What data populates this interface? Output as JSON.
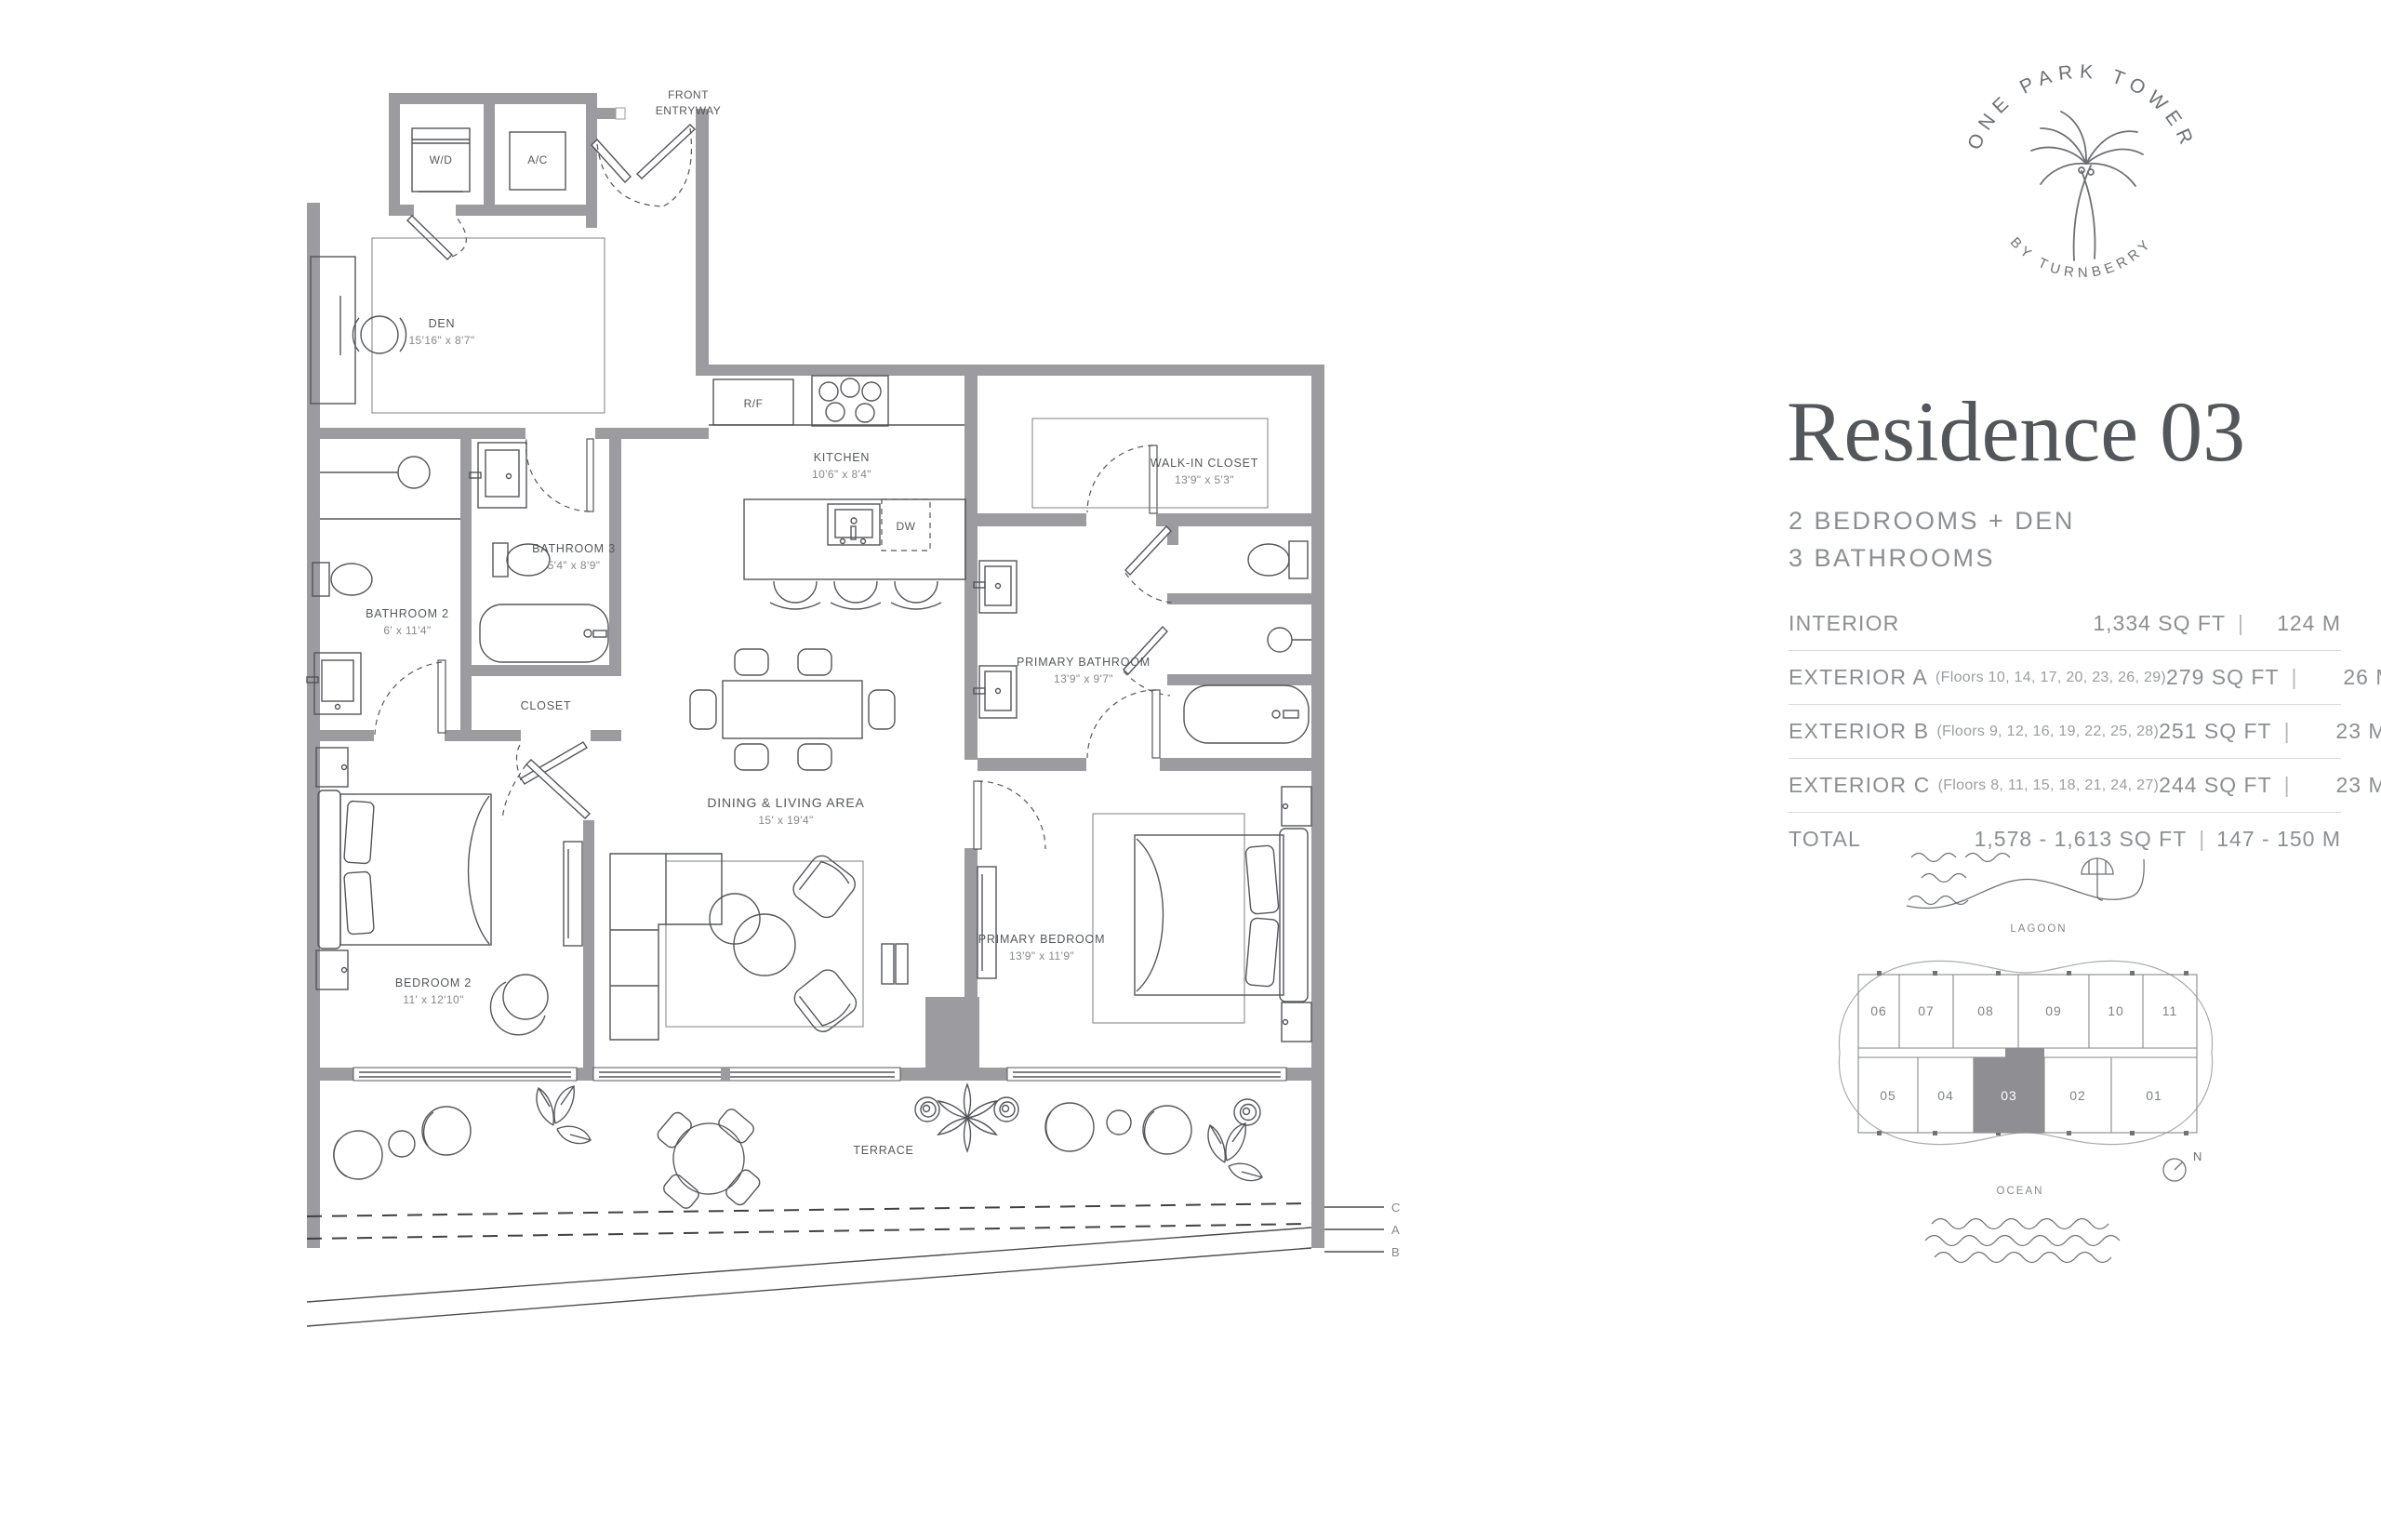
{
  "brand": {
    "arc_top": "ONE PARK TOWER",
    "arc_bottom": "BY TURNBERRY"
  },
  "residence": {
    "title": "Residence 03",
    "bedrooms": "2 BEDROOMS + DEN",
    "bathrooms": "3 BATHROOMS"
  },
  "table": {
    "rows": [
      {
        "label": "INTERIOR",
        "floors": "",
        "sqft": "1,334 SQ FT",
        "m": "124 M"
      },
      {
        "label": "EXTERIOR A",
        "floors": "(Floors 10, 14, 17, 20, 23, 26, 29)",
        "sqft": "279 SQ FT",
        "m": "26 M"
      },
      {
        "label": "EXTERIOR B",
        "floors": "(Floors 9, 12, 16, 19, 22, 25, 28)",
        "sqft": "251 SQ FT",
        "m": "23 M"
      },
      {
        "label": "EXTERIOR C",
        "floors": "(Floors 8, 11, 15, 18, 21, 24, 27)",
        "sqft": "244 SQ FT",
        "m": "23 M"
      },
      {
        "label": "TOTAL",
        "floors": "",
        "sqft": "1,578 - 1,613 SQ FT",
        "m": "147 - 150 M"
      }
    ],
    "pipe": "|"
  },
  "keyplan": {
    "lagoon": "LAGOON",
    "ocean": "OCEAN",
    "north": "N",
    "top_units": [
      "06",
      "07",
      "08",
      "09",
      "10",
      "11"
    ],
    "bottom_units": [
      "05",
      "04",
      "03",
      "02",
      "01"
    ],
    "highlighted_unit": "03",
    "highlight_color": "#8f8f93"
  },
  "plan": {
    "entry_l1": "FRONT",
    "entry_l2": "ENTRYWAY",
    "wd": "W/D",
    "ac": "A/C",
    "rf": "R/F",
    "dw": "DW",
    "den": "DEN",
    "den_dims": "15'16\" x 8'7\"",
    "kitchen": "KITCHEN",
    "kitchen_dims": "10'6\" x 8'4\"",
    "wic": "WALK-IN CLOSET",
    "wic_dims": "13'9\" x 5'3\"",
    "bath3": "BATHROOM 3",
    "bath3_dims": "5'4\" x 8'9\"",
    "bath2": "BATHROOM 2",
    "bath2_dims": "6' x 11'4\"",
    "closet": "CLOSET",
    "pbath": "PRIMARY BATHROOM",
    "pbath_dims": "13'9\" x 9'7\"",
    "living": "DINING & LIVING AREA",
    "living_dims": "15' x 19'4\"",
    "bed2": "BEDROOM 2",
    "bed2_dims": "11' x 12'10\"",
    "pbed": "PRIMARY BEDROOM",
    "pbed_dims": "13'9\" x 11'9\"",
    "terrace": "TERRACE",
    "line_c": "C",
    "line_a": "A",
    "line_b": "B"
  },
  "colors": {
    "wall": "#9b9ba0",
    "line": "#54565a",
    "text": "#55585b",
    "muted": "#8c8f91",
    "highlight": "#8f8f93"
  }
}
